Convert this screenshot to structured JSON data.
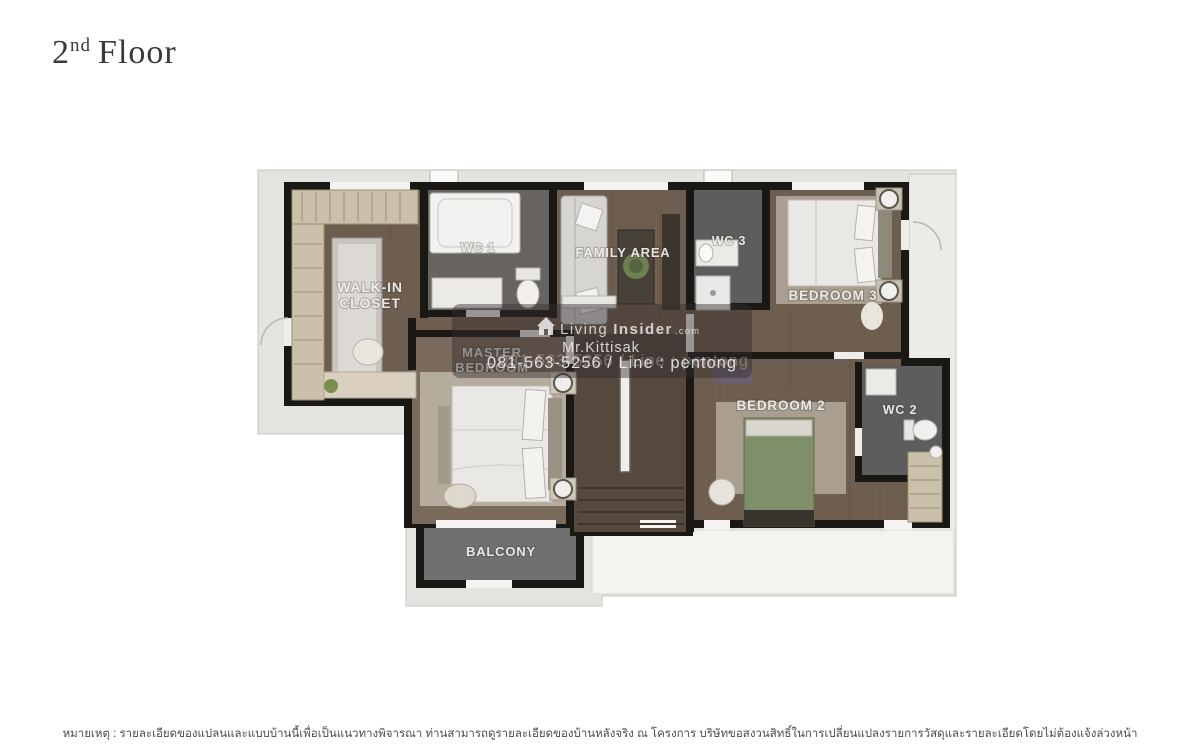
{
  "title": {
    "number": "2",
    "ordinal": "nd",
    "word": "Floor"
  },
  "plan": {
    "rooms": {
      "walk_in_closet_line1": "WALK-IN",
      "walk_in_closet_line2": "CLOSET",
      "wc1": "WC 1",
      "family_area": "FAMILY AREA",
      "wc3": "WC 3",
      "bedroom3": "BEDROOM 3",
      "master_line1": "MASTER",
      "master_line2": "BEDROOM",
      "bedroom2": "BEDROOM 2",
      "wc2": "WC 2",
      "balcony": "BALCONY"
    }
  },
  "watermark": {
    "brand_living": "Living",
    "brand_insider": "Insider",
    "brand_tld": ".com",
    "agent": "Mr.Kittisak",
    "contact": "081-563-5256 / Line : pentong"
  },
  "footer": {
    "note": "หมายเหตุ : รายละเอียดของแปลนและแบบบ้านนี้เพื่อเป็นแนวทางพิจารณา ท่านสามารถดูรายละเอียดของบ้านหลังจริง ณ โครงการ บริษัทขอสงวนสิทธิ์ในการเปลี่ยนแปลงรายการวัสดุและรายละเอียดโดยไม่ต้องแจ้งล่วงหน้า"
  },
  "palette": {
    "wall": "#1a1815",
    "wood_floor": "#6d5e4f",
    "wood_floor_dark": "#55483c",
    "wood_floor_light": "#7a6a5c",
    "bathroom_floor": "#67645f",
    "bathroom_floor_dark": "#5d5d5d",
    "balcony_floor": "#707070",
    "pad": "#e4e3e0",
    "terrace": "#f5f3ef",
    "side_strip": "#edebe8",
    "rug": "#a99e90",
    "bed_white": "#eae8e4",
    "bed_green": "#7e8f69",
    "wardrobe": "#cbc0a9",
    "sofa": "#d7d5d1",
    "watermark_band": "#322c2e",
    "label_text": "#f2f1ef",
    "title_text": "#3a3a3a",
    "footer_text": "#4c4c4c"
  }
}
